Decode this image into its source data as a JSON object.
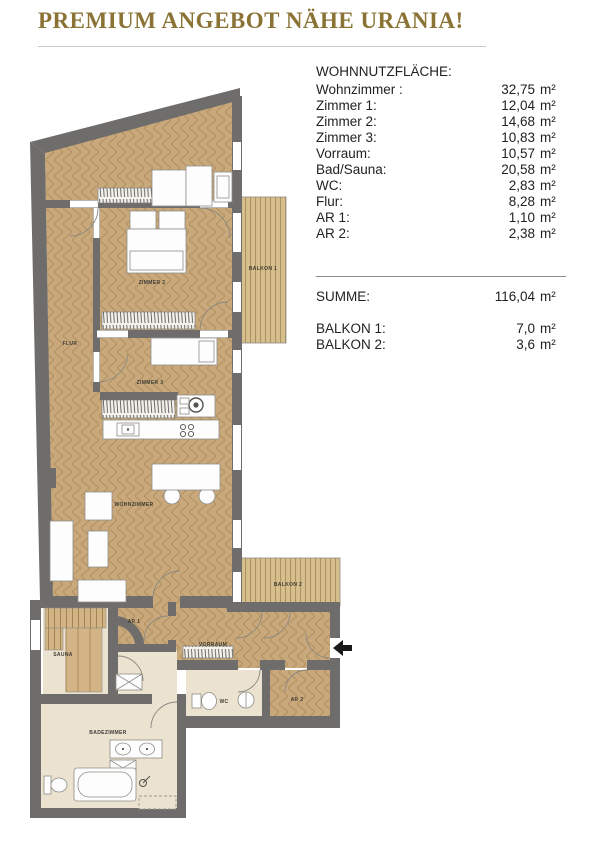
{
  "header": {
    "title": "PREMIUM ANGEBOT NÄHE URANIA!"
  },
  "table": {
    "heading": "WOHNNUTZFLÄCHE:",
    "rows": [
      {
        "label": "Wohnzimmer :",
        "value": "32,75",
        "unit": "m²"
      },
      {
        "label": "Zimmer 1:",
        "value": "12,04",
        "unit": "m²"
      },
      {
        "label": "Zimmer 2:",
        "value": "14,68",
        "unit": "m²"
      },
      {
        "label": "Zimmer 3:",
        "value": "10,83",
        "unit": "m²"
      },
      {
        "label": "Vorraum:",
        "value": "10,57",
        "unit": "m²"
      },
      {
        "label": "Bad/Sauna:",
        "value": "20,58",
        "unit": "m²"
      },
      {
        "label": "WC:",
        "value": "2,83",
        "unit": "m²"
      },
      {
        "label": "Flur:",
        "value": "8,28",
        "unit": "m²"
      },
      {
        "label": "AR 1:",
        "value": "1,10",
        "unit": "m²"
      },
      {
        "label": "AR 2:",
        "value": "2,38",
        "unit": "m²"
      }
    ],
    "summe": {
      "label": "SUMME:",
      "value": "116,04",
      "unit": "m²"
    },
    "balkone": [
      {
        "label": "BALKON 1:",
        "value": "7,0",
        "unit": "m²"
      },
      {
        "label": "BALKON 2:",
        "value": "3,6",
        "unit": "m²"
      }
    ]
  },
  "floorplan": {
    "labels": {
      "flur": "FLUR",
      "zimmer2": "ZIMMER 2",
      "zimmer3": "ZIMMER 3",
      "wohnzimmer": "WOHNZIMMER",
      "balkon1": "BALKON 1",
      "balkon2": "BALKON 2",
      "ar1": "AR 1",
      "ar2": "AR 2",
      "vorraum": "VORRAUM",
      "sauna": "SAUNA",
      "wc": "WC",
      "badezimmer": "BADEZIMMER"
    },
    "colors": {
      "title_gold": "#8a7334",
      "wall": "#6e6d6b",
      "wood_floor": "#c9a97c",
      "cream_floor": "#ebe2d0",
      "balcony_deck": "#d7bf8d"
    }
  }
}
